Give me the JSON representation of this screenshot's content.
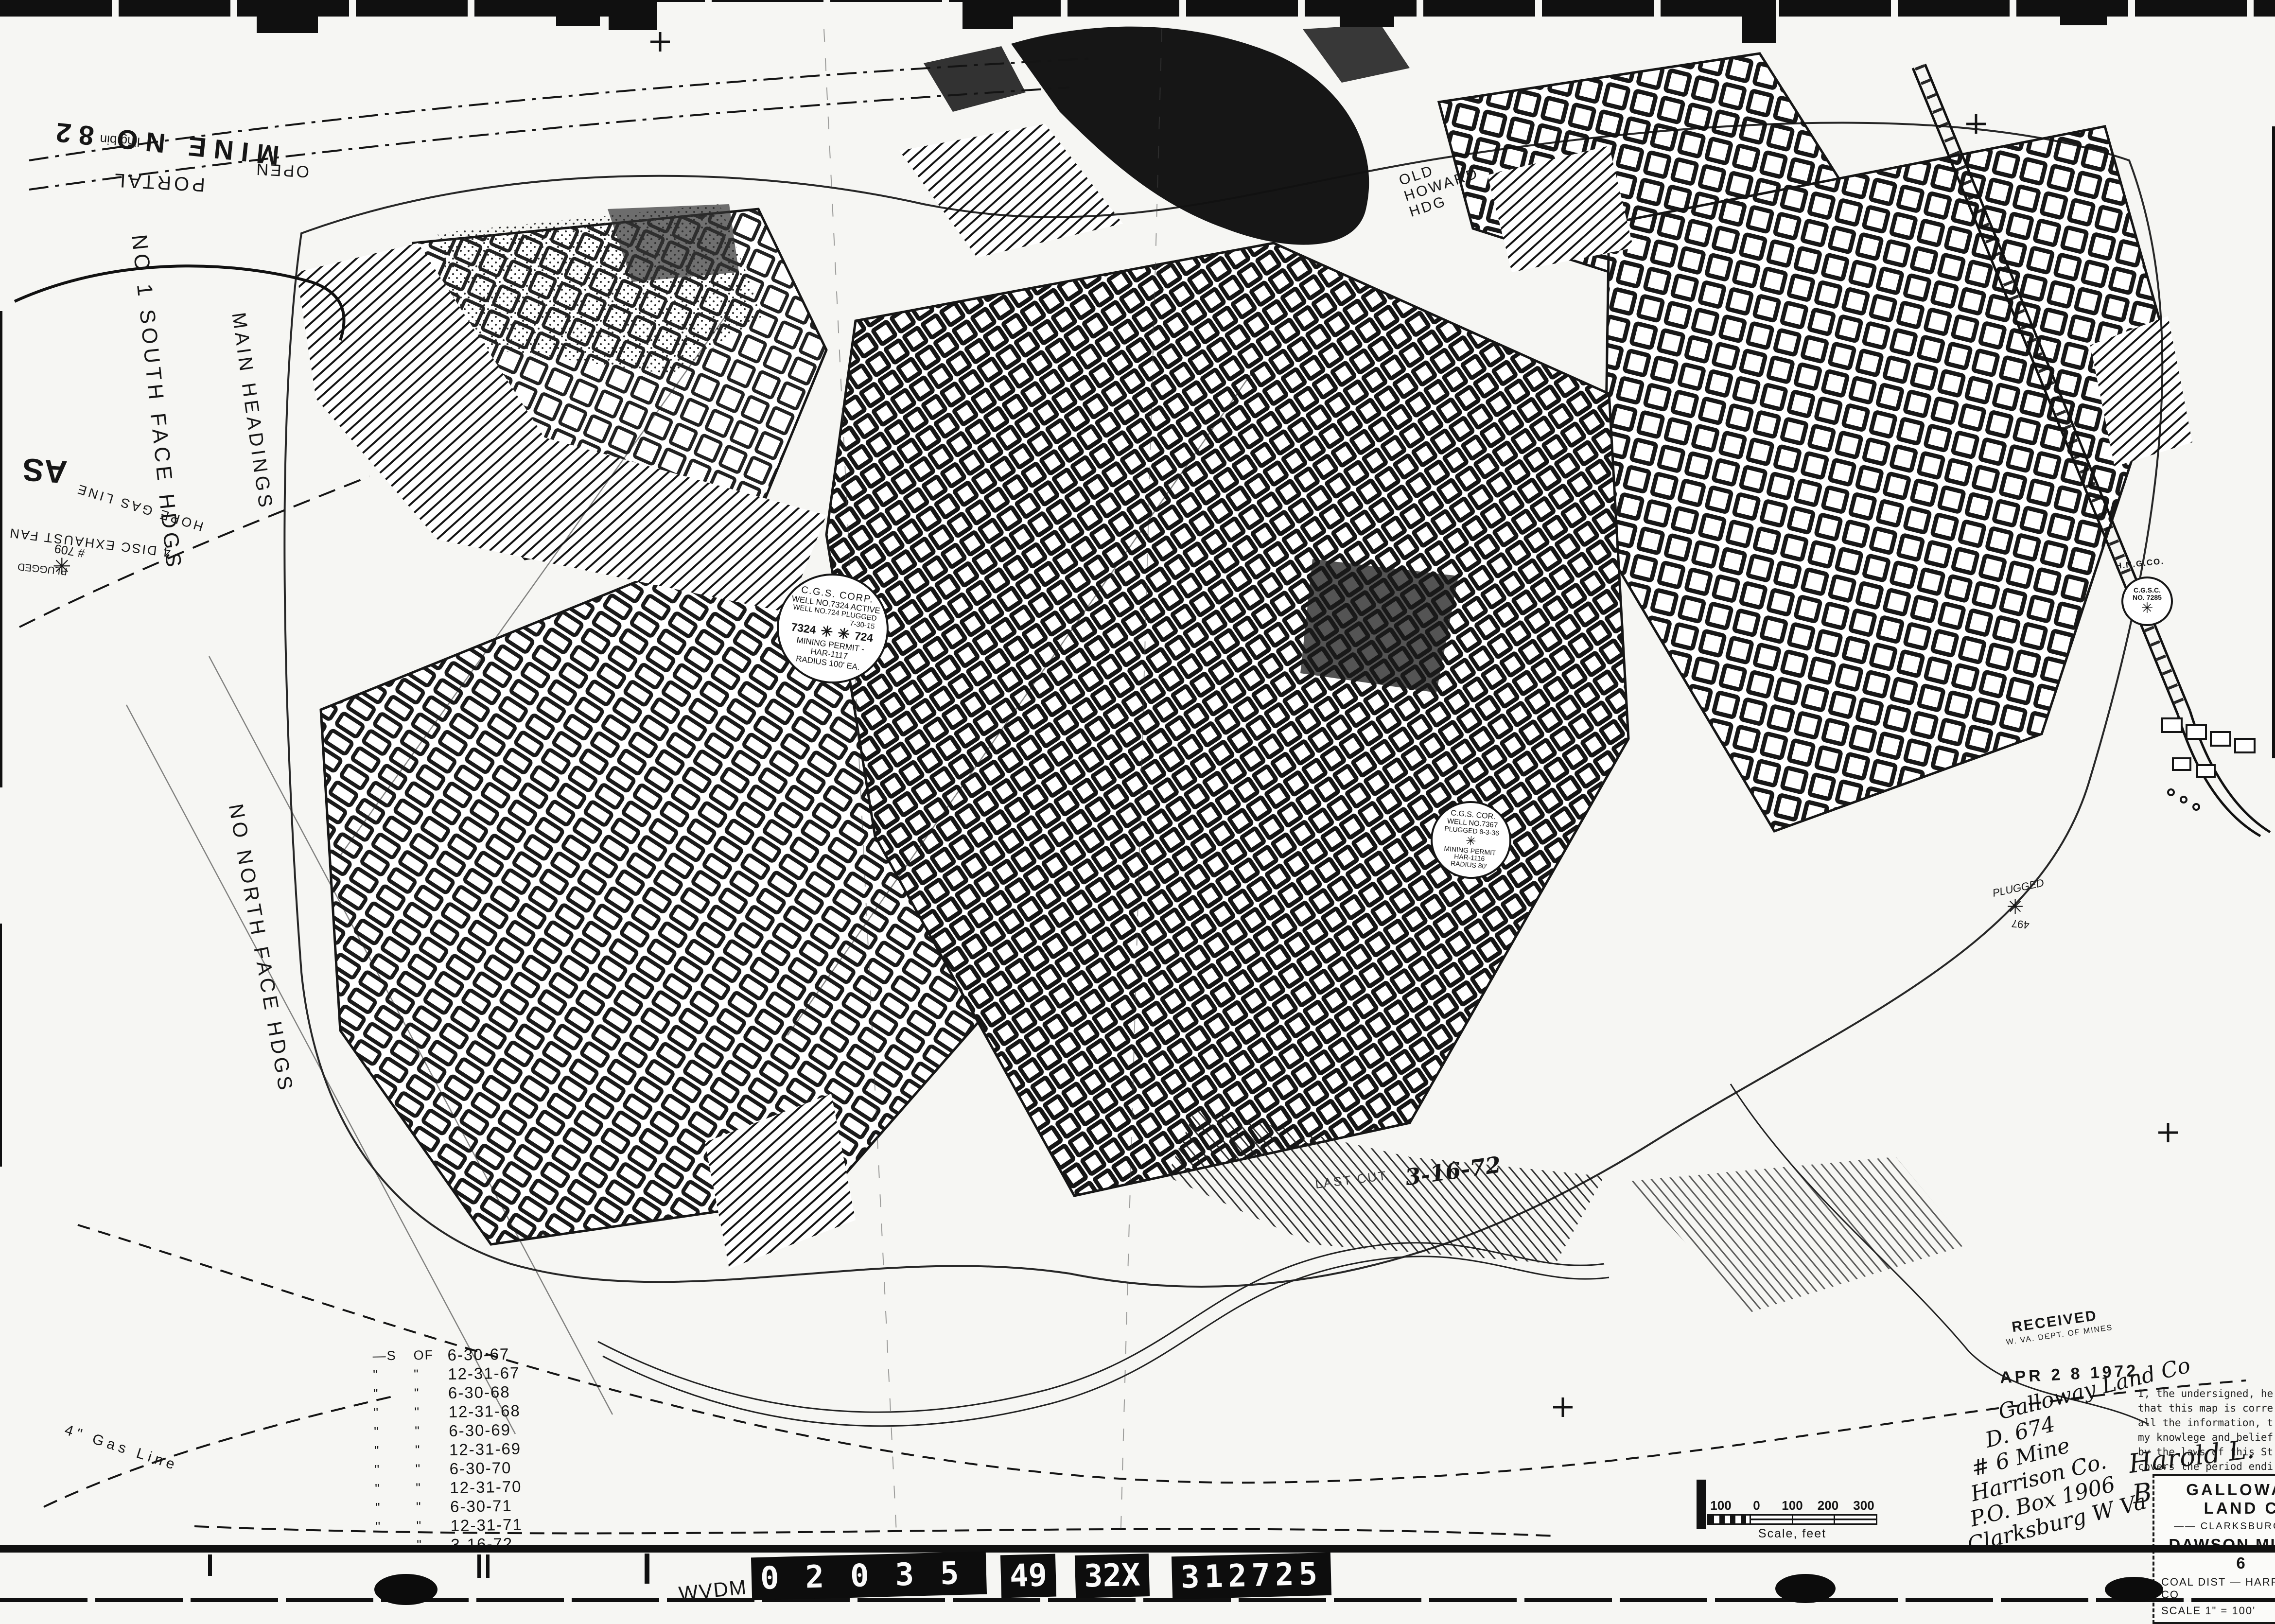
{
  "film_strip": {
    "agency": "WVDM",
    "plates": [
      "02035",
      "49",
      "32X",
      "312725"
    ]
  },
  "title_block": {
    "company": "GALLOWAY LAND C",
    "location": "—— CLARKSBURG W V",
    "mine": "DAWSON MINE - 6",
    "district": "COAL DIST — HARRISON CO",
    "scale": "SCALE 1\" = 100'",
    "date_label": "DATE"
  },
  "received_stamp": {
    "line1": "RECEIVED",
    "line2": "W. VA. DEPT. OF MINES",
    "date": "APR 2 8 1972"
  },
  "certification": {
    "lines": [
      "I, the undersigned, hereby ce",
      "that this map is correct and",
      "all the information, to the",
      "my knowlege and belief, req",
      "by the laws of this State, a"
    ],
    "last_line": "covers the period ending",
    "period_ending": "3-16-72",
    "signature": "Harold L. Beatti"
  },
  "handwritten_note": {
    "lines": [
      "Galloway Land Co",
      "D. 674",
      "# 6 Mine",
      "Harrison Co.",
      "P.O. Box 1906",
      "Clarksburg W Va 26 30"
    ]
  },
  "as_of_list": {
    "rows": [
      {
        "a": "—S",
        "b": "OF",
        "date": "6-30-67"
      },
      {
        "a": "\"",
        "b": "\"",
        "date": "12-31-67"
      },
      {
        "a": "\"",
        "b": "\"",
        "date": "6-30-68"
      },
      {
        "a": "\"",
        "b": "\"",
        "date": "12-31-68"
      },
      {
        "a": "\"",
        "b": "\"",
        "date": "6-30-69"
      },
      {
        "a": "\"",
        "b": "\"",
        "date": "12-31-69"
      },
      {
        "a": "\"",
        "b": "\"",
        "date": "6-30-70"
      },
      {
        "a": "\"",
        "b": "\"",
        "date": "12-31-70"
      },
      {
        "a": "\"",
        "b": "\"",
        "date": "6-30-71"
      },
      {
        "a": "\"",
        "b": "\"",
        "date": "12-31-71"
      },
      {
        "a": "",
        "b": "\"",
        "date": "3-16-72"
      }
    ]
  },
  "wells": {
    "well_7324": {
      "company": "C.G.S. CORP.",
      "line2": "WELL NO.7324 ACTIVE",
      "line3": "WELL NO.724 PLUGGED",
      "date3": "7-30-15",
      "left_no": "7324",
      "right_no": "724",
      "permit1": "MINING PERMIT -",
      "permit2": "HAR-1117",
      "radius": "RADIUS 100' EA."
    },
    "well_7367": {
      "company": "C.G.S. COR.",
      "line2": "WELL NO.7367",
      "line3": "PLUGGED 8-3-36",
      "permit1": "MINING PERMIT",
      "permit2": "HAR-1116",
      "radius": "RADIUS 80'"
    },
    "well_7285": {
      "owner": "H.N.G.CO.",
      "line1": "C.G.S.C.",
      "line2": "NO. 7285"
    }
  },
  "map_labels": {
    "mine_no": "MINE NO 82",
    "portal": "PORTAL",
    "open": "OPEN",
    "south_hdgs": "NO 1 SOUTH FACE HDGS",
    "main_hdgs": "MAIN HEADINGS",
    "north_face": "NO NORTH FACE HDGS",
    "old_howard": "OLD HOWARD HDG",
    "hope_gas": "HOPE GAS LINE",
    "exhaust_fan": "4 DISC EXHAUST FAN",
    "plugged": "PLUGGED",
    "well_709": "# 709",
    "well_497": "497",
    "gas_line": "4\" Gas Line",
    "last_cut": "LAST CUT",
    "last_cut_date": "3-16-72",
    "ash": "AS",
    "bin": "ling bin"
  },
  "scale_bar": {
    "ticks": [
      "100",
      "0",
      "100",
      "200",
      "300"
    ],
    "caption": "Scale, feet"
  },
  "icons": {
    "plugged_well": "✳"
  }
}
